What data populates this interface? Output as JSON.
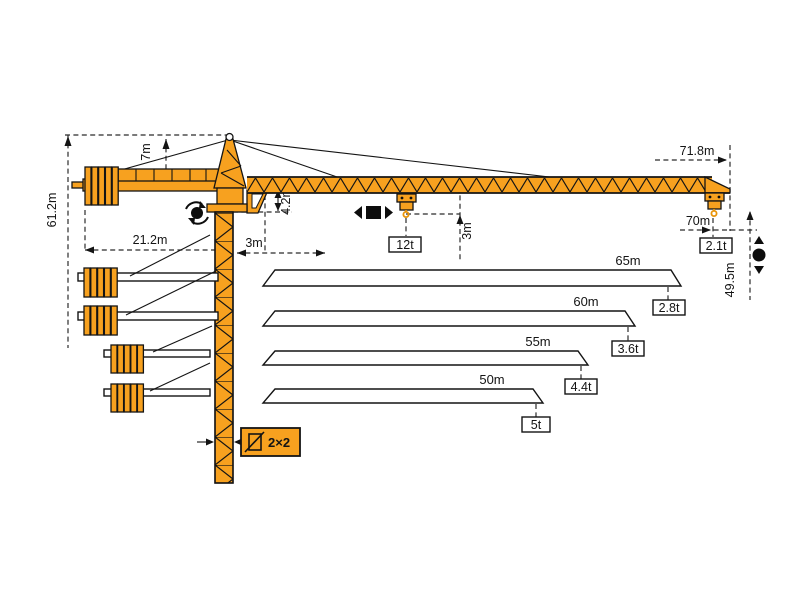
{
  "dims": {
    "apex_height": "7m",
    "hook_height_max": "61.2m",
    "counterjib_radius": "21.2m",
    "min_radius": "3m",
    "foot_clearance": "4.2m",
    "hook_clearance": "3m",
    "tip_radius": "71.8m",
    "max_hook_radius": "70m",
    "tip_capacity": "2.1t",
    "max_capacity": "12t",
    "tip_hook_height": "49.5m",
    "mast_section": "2×2"
  },
  "jib_options": [
    {
      "length": "65m",
      "capacity": "2.8t"
    },
    {
      "length": "60m",
      "capacity": "3.6t"
    },
    {
      "length": "55m",
      "capacity": "4.4t"
    },
    {
      "length": "50m",
      "capacity": "5t"
    }
  ],
  "icons": {
    "slew": "slew-rotation-icon",
    "trolley": "trolley-travel-icon",
    "hoist": "hook-hoist-icon",
    "mast_section": "mast-section-icon"
  },
  "colors": {
    "crane": "#F7A11F",
    "outline": "#141414",
    "dimension_line": "#2b2b2b"
  }
}
